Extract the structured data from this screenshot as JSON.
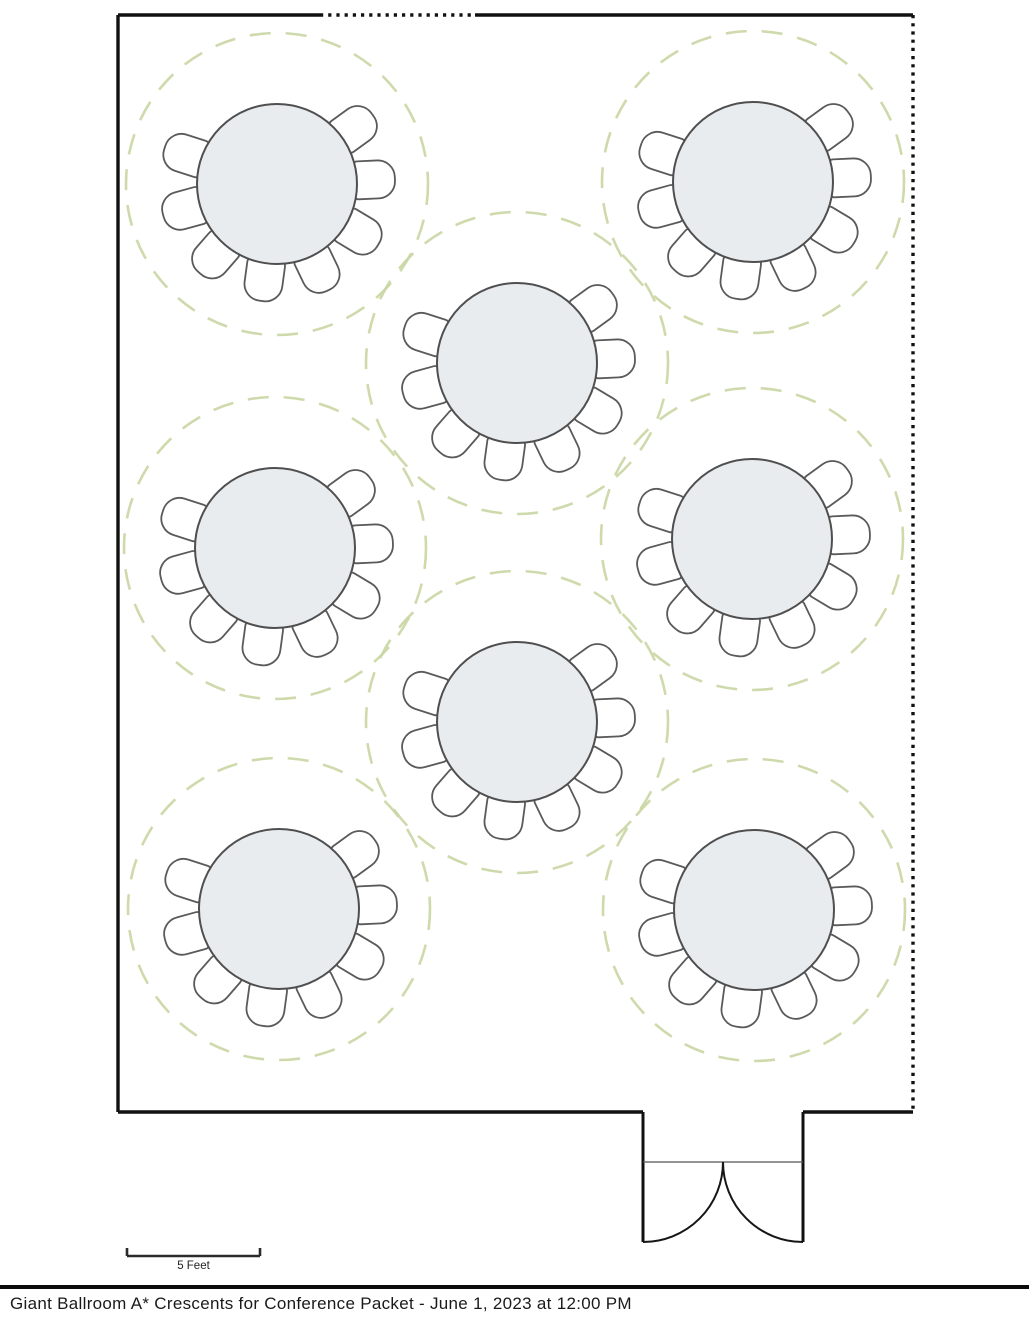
{
  "document": {
    "title": "Giant Ballroom A* Crescents for Conference Packet - June 1, 2023 at 12:00 PM"
  },
  "scale_bar": {
    "label": "5 Feet",
    "x1": 127,
    "x2": 260,
    "y": 1256,
    "tick_height": 8
  },
  "room": {
    "wall_segments": [
      {
        "x1": 118,
        "y1": 15,
        "x2": 320,
        "y2": 15,
        "style": "solid"
      },
      {
        "x1": 320,
        "y1": 15,
        "x2": 475,
        "y2": 15,
        "style": "dotted"
      },
      {
        "x1": 475,
        "y1": 15,
        "x2": 913,
        "y2": 15,
        "style": "solid"
      },
      {
        "x1": 118,
        "y1": 15,
        "x2": 118,
        "y2": 1112,
        "style": "solid"
      },
      {
        "x1": 913,
        "y1": 15,
        "x2": 913,
        "y2": 1112,
        "style": "dotted"
      },
      {
        "x1": 118,
        "y1": 1112,
        "x2": 643,
        "y2": 1112,
        "style": "solid"
      },
      {
        "x1": 803,
        "y1": 1112,
        "x2": 913,
        "y2": 1112,
        "style": "solid"
      }
    ],
    "door": {
      "jambs": [
        {
          "x": 643,
          "y1": 1112,
          "y2": 1242
        },
        {
          "x": 803,
          "y1": 1112,
          "y2": 1242
        }
      ],
      "header": {
        "x1": 643,
        "x2": 803,
        "y": 1162
      },
      "swings": [
        "M 643 1242 A 80 80 0 0 0 723 1162",
        "M 803 1242 A 80 80 0 0 1 723 1162"
      ]
    }
  },
  "layout": {
    "table_style": "crescent-rounds",
    "table_count": 8,
    "chairs_per_table": 8,
    "table_radius": 80,
    "spacing_circle_radius": 151,
    "chair_angles_deg": [
      54,
      87.4,
      120.9,
      154.3,
      187.7,
      221.1,
      254.6,
      288
    ],
    "chair": {
      "width": 38,
      "length": 42,
      "inset": 76,
      "outer_radius": 17,
      "inner_radius": 5
    },
    "tables": [
      {
        "cx": 277,
        "cy": 184
      },
      {
        "cx": 753,
        "cy": 182
      },
      {
        "cx": 517,
        "cy": 363
      },
      {
        "cx": 275,
        "cy": 548
      },
      {
        "cx": 752,
        "cy": 539
      },
      {
        "cx": 517,
        "cy": 722
      },
      {
        "cx": 279,
        "cy": 909
      },
      {
        "cx": 754,
        "cy": 910
      }
    ]
  },
  "colors": {
    "wall": "#111111",
    "outline": "#4f4f4f",
    "chair_outline": "#5a5a5a",
    "table_fill": "#e8ecef",
    "chair_fill": "#ffffff",
    "spacing_circle": "#c9d6a3",
    "door_header": "#555555",
    "scale_bar": "#2b2b2b",
    "text": "#1a1a1a"
  }
}
